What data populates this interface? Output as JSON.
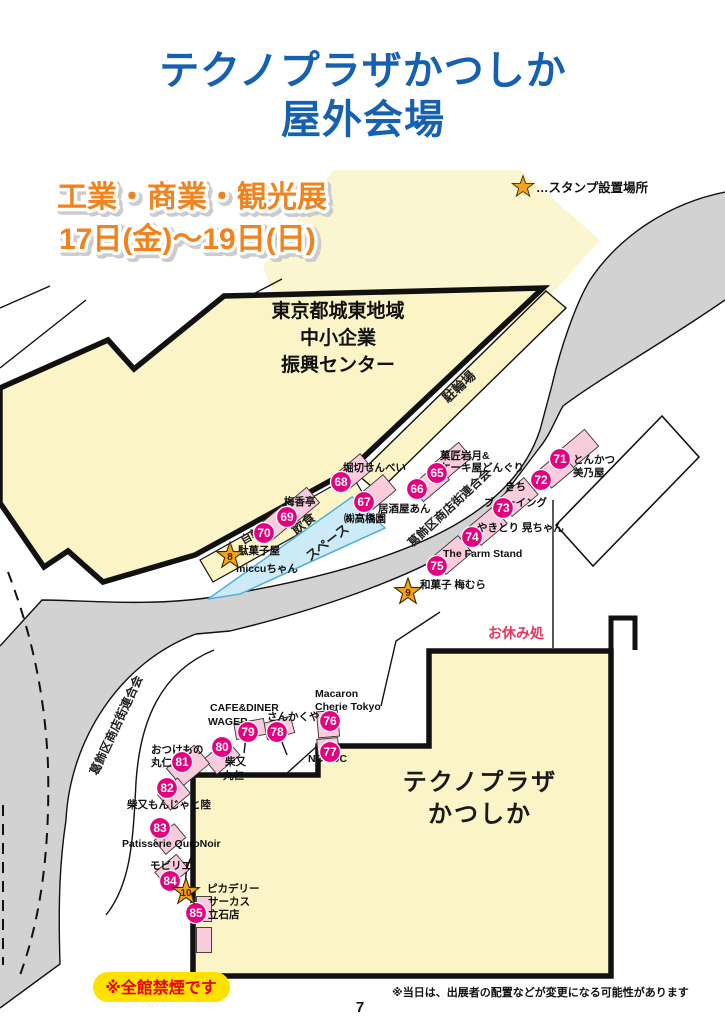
{
  "page": {
    "title_line1": "テクノプラザかつしか",
    "title_line2": "屋外会場",
    "heading_line1": "工業・商業・観光展",
    "heading_line2": "17日(金)～19日(日)",
    "no_smoking": "※全館禁煙です",
    "note": "※当日は、出展者の配置などが変更になる可能性があります",
    "page_number": "7"
  },
  "legend": {
    "stamp_note": "…スタンプ設置場所"
  },
  "map": {
    "buildings": {
      "shinko_l1": "東京都城東地域",
      "shinko_l2": "中小企業",
      "shinko_l3": "振興センター",
      "technoplaza_l1": "テクノプラザ",
      "technoplaza_l2": "かつしか",
      "churinjo": "駐輪場"
    },
    "areas": {
      "bike_path": "自転車用通路",
      "eat_l1": "飲食",
      "eat_l2": "スペース",
      "rest": "お休み処",
      "shotengai": "葛飾区商店街連合会"
    },
    "stamp_points": {
      "s8": "8",
      "s9": "9",
      "s10": "10"
    }
  },
  "booths": {
    "n65": "65",
    "n66": "66",
    "n67": "67",
    "n68": "68",
    "n69": "69",
    "n70": "70",
    "n71": "71",
    "n72": "72",
    "n73": "73",
    "n74": "74",
    "n75": "75",
    "n76": "76",
    "n77": "77",
    "n78": "78",
    "n79": "79",
    "n80": "80",
    "n81": "81",
    "n82": "82",
    "n83": "83",
    "n84": "84",
    "n85": "85"
  },
  "labels": {
    "horikiri": "堀切せんべい",
    "kasho_l1": "菓匠岩月&",
    "kasho_l2": "ケーキ屋どんぐり",
    "izakaya": "居酒屋あん",
    "takahashi": "㈱高橋園",
    "baiko": "梅香亭",
    "dagashi_l1": "駄菓子屋",
    "dagashi_l2": "miccuちゃん",
    "tonkatsu_l1": "とんかつ",
    "tonkatsu_l2": "美乃屋",
    "kichi_l1": "きち",
    "kichi_l2": "ブルーイング",
    "yakitori": "やきとり 晃ちゃん",
    "farm": "The Farm Stand",
    "umemura": "和菓子 梅むら",
    "cafe_l1": "CAFE&DINER",
    "cafe_l2": "WAGER",
    "sankaku": "さんかくや",
    "macaron_l1": "Macaron",
    "macaron_l2": "Cherie Tokyo",
    "noroc": "NOROC",
    "otsuke_l1": "おつけもの",
    "otsuke_l2": "丸仁",
    "shibamata_l1": "柴又",
    "shibamata_l2": "丸仁",
    "monja": "柴又もんじゃと陸",
    "patisserie": "Patisserie QuroNoir",
    "mobilier": "モビリエ",
    "pica_l1": "ピカデリー",
    "pica_l2": "サーカス",
    "pica_l3": "立石店"
  },
  "colors": {
    "title_blue": "#1660b2",
    "heading_orange": "#f0831e",
    "badge_magenta": "#e4007f",
    "booth_pink": "#f8ccdd",
    "map_yellow": "#faf4c6",
    "road_gray": "#d2d2d2",
    "star_orange": "#f5a21c",
    "eat_blue": "#cdeaf7",
    "no_smoking_yellow": "#ffe100",
    "warning_red": "#e60012",
    "rest_red": "#e73562"
  }
}
